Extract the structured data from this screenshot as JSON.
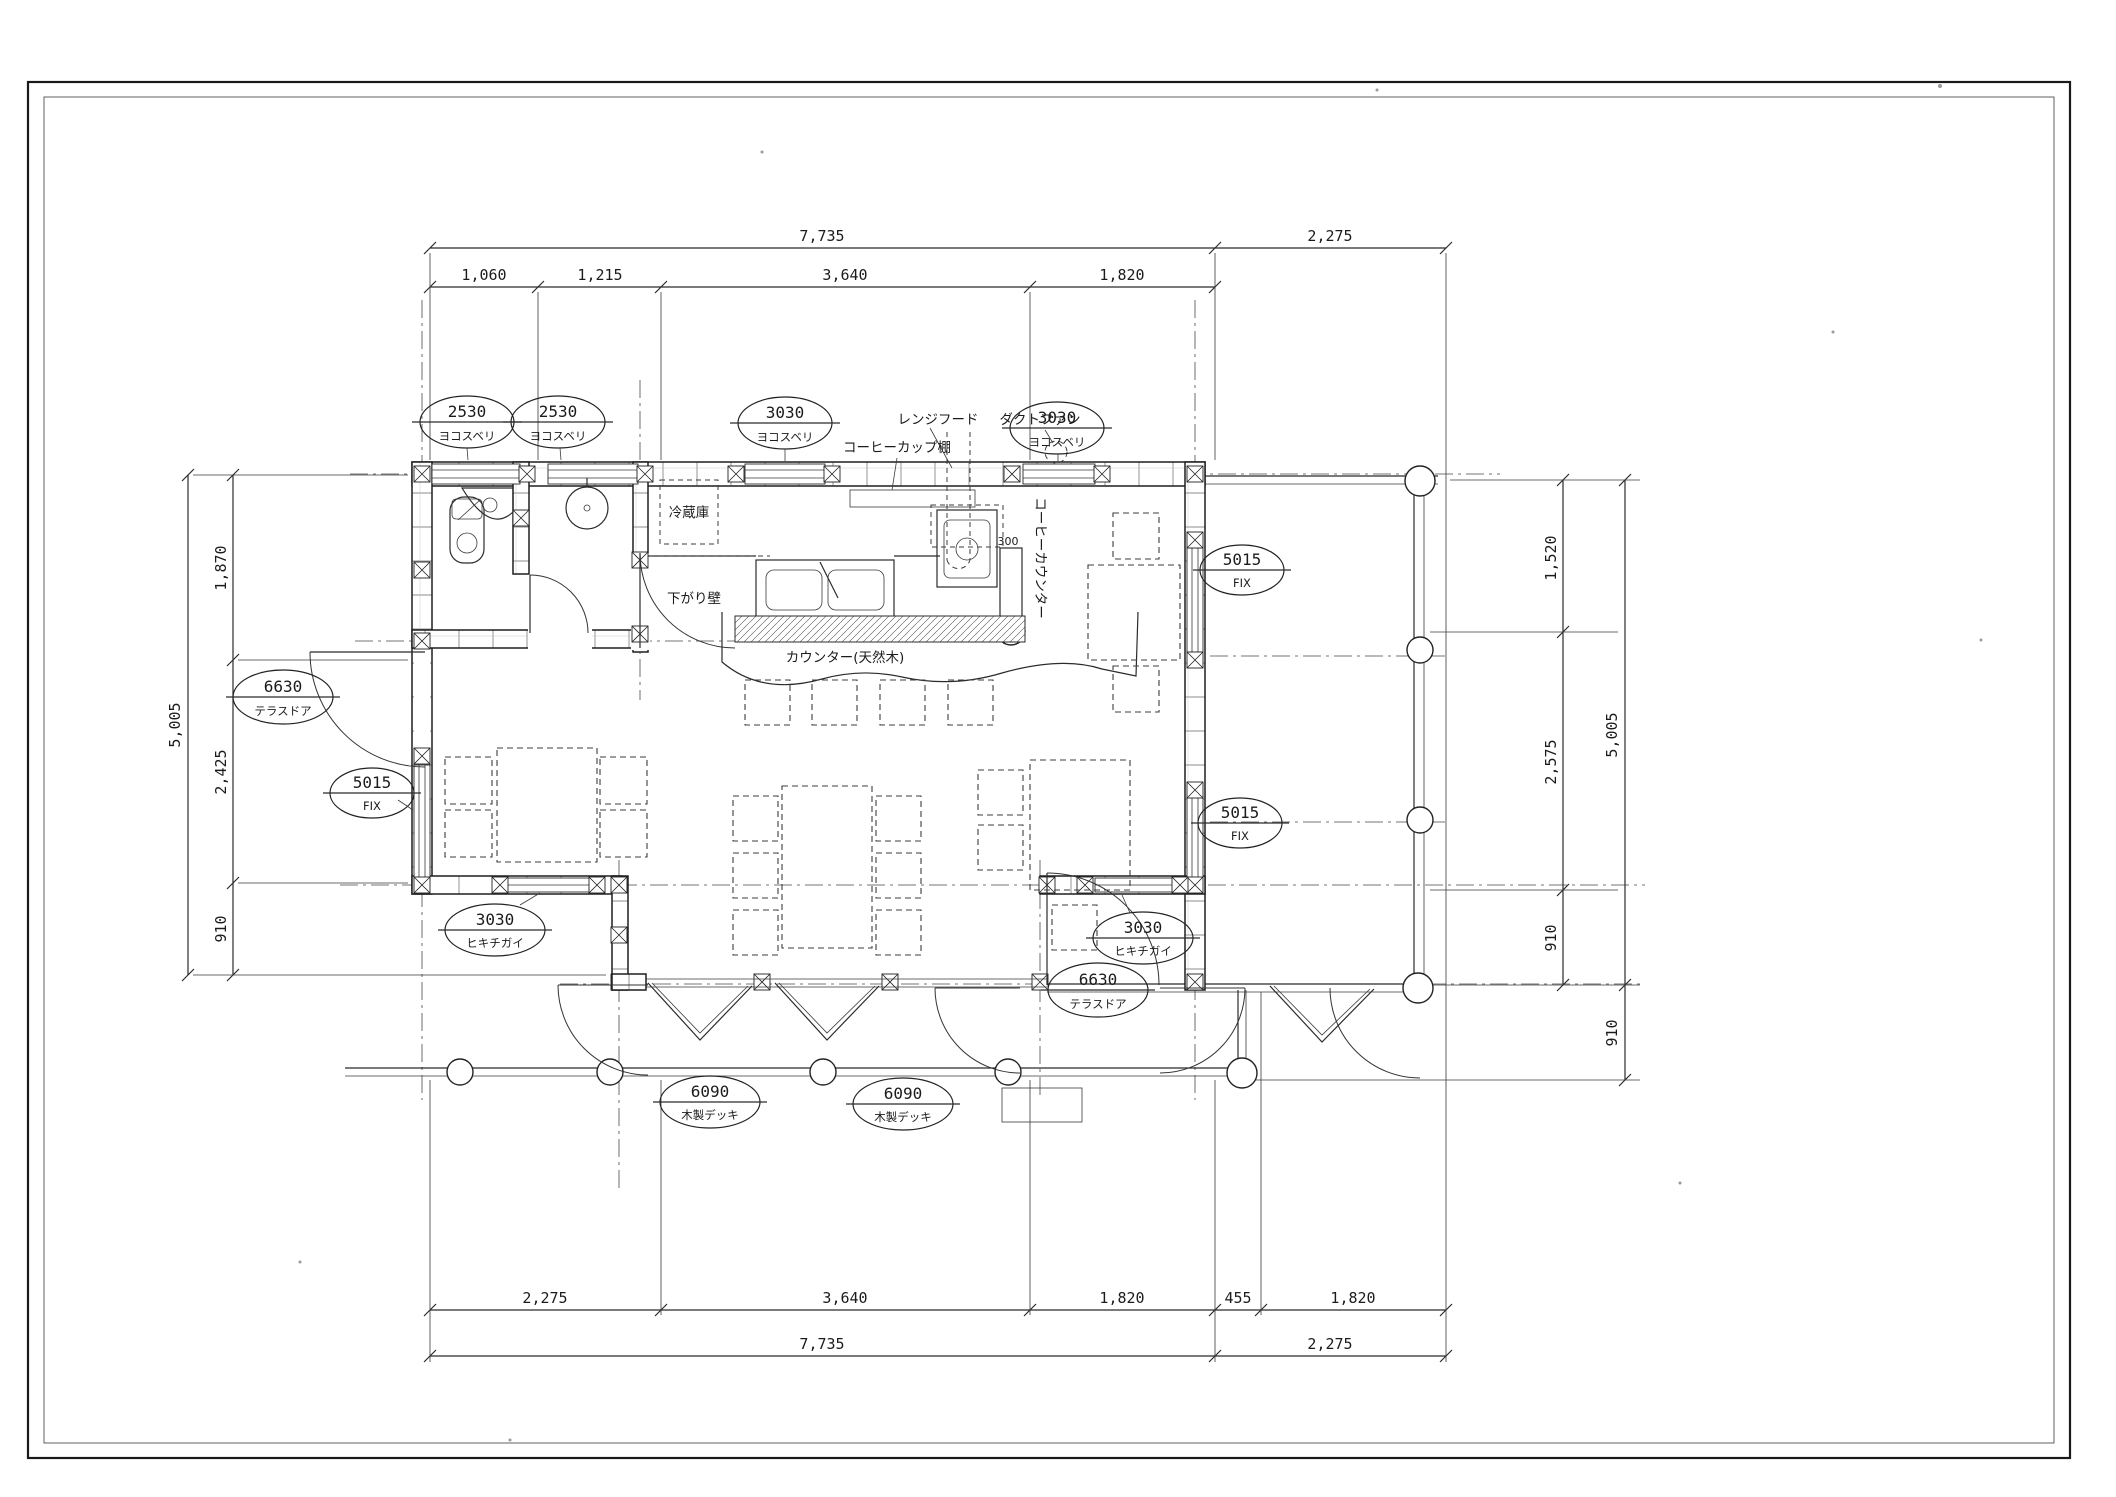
{
  "dimensions": {
    "top": {
      "overall": "7,735",
      "overall_right": "2,275",
      "seg1": "1,060",
      "seg2": "1,215",
      "seg3": "3,640",
      "seg4": "1,820"
    },
    "bottom": {
      "seg1": "2,275",
      "seg2": "3,640",
      "seg3": "1,820",
      "seg4": "455",
      "seg5": "1,820",
      "overall_left": "7,735",
      "overall_right": "2,275"
    },
    "left": {
      "overall": "5,005",
      "seg1": "1,870",
      "seg2": "2,425",
      "seg3": "910"
    },
    "right": {
      "seg1": "1,520",
      "seg2": "2,575",
      "seg3": "910",
      "overall": "5,005",
      "deck_depth": "910"
    }
  },
  "callouts": {
    "top_window_1": {
      "size": "2530",
      "type": "ヨコスベリ"
    },
    "top_window_2": {
      "size": "2530",
      "type": "ヨコスベリ"
    },
    "top_window_3": {
      "size": "3030",
      "type": "ヨコスベリ"
    },
    "top_window_4": {
      "size": "3030",
      "type": "ヨコスベリ"
    },
    "terrace_door_left": {
      "size": "6630",
      "type": "テラスドア"
    },
    "fix_left": {
      "size": "5015",
      "type": "FIX"
    },
    "fix_right_upper": {
      "size": "5015",
      "type": "FIX"
    },
    "fix_right_lower": {
      "size": "5015",
      "type": "FIX"
    },
    "sliding_left": {
      "size": "3030",
      "type": "ヒキチガイ"
    },
    "sliding_right": {
      "size": "3030",
      "type": "ヒキチガイ"
    },
    "terrace_door_bottom": {
      "size": "6630",
      "type": "テラスドア"
    },
    "deck_tag_left": {
      "size": "6090",
      "type": "木製デッキ"
    },
    "deck_tag_right": {
      "size": "6090",
      "type": "木製デッキ"
    }
  },
  "labels": {
    "range_hood": "レンジフード",
    "duct_fan": "ダクトファン",
    "coffee_cup_shelf": "コーヒーカップ棚",
    "refrigerator": "冷蔵庫",
    "dropped_wall": "下がり壁",
    "counter_natural_wood": "カウンター(天然木)",
    "coffee_counter": "コーヒーカウンター",
    "counter_depth": "300"
  }
}
